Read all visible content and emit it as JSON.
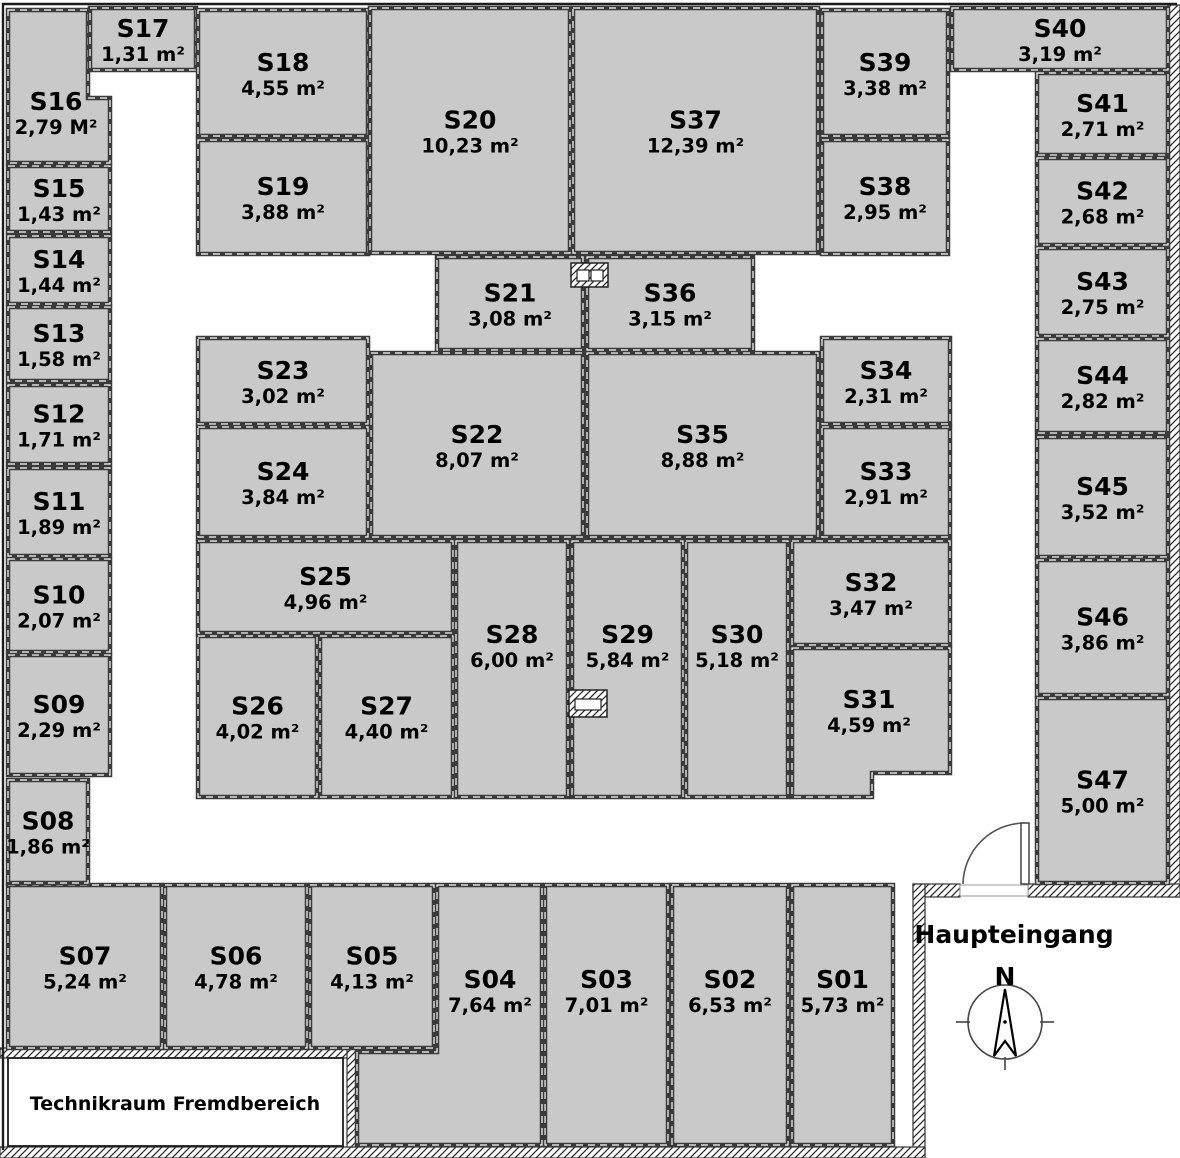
{
  "labels": {
    "haupteingang": "Haupteingang",
    "technikraum": "Technikraum Fremdbereich",
    "compass_n": "N"
  },
  "colors": {
    "room_fill": "#c9c9c9",
    "wall_stroke": "#3a3a3a",
    "text": "#000000"
  },
  "rooms": [
    {
      "id": "S01",
      "area": "5,73 m²",
      "x": 792,
      "y": 885,
      "w": 101,
      "h": 260,
      "ly": 990
    },
    {
      "id": "S02",
      "area": "6,53 m²",
      "x": 672,
      "y": 885,
      "w": 116,
      "h": 260,
      "ly": 990
    },
    {
      "id": "S03",
      "area": "7,01 m²",
      "x": 545,
      "y": 885,
      "w": 123,
      "h": 260,
      "ly": 990
    },
    {
      "id": "S04",
      "area": "7,64 m²",
      "pts": "437,885 542,885 542,1145 357,1145 357,1052 437,1052",
      "lx": 490,
      "ly": 990
    },
    {
      "id": "S05",
      "area": "4,13 m²",
      "x": 310,
      "y": 885,
      "w": 124,
      "h": 163
    },
    {
      "id": "S06",
      "area": "4,78 m²",
      "x": 165,
      "y": 885,
      "w": 142,
      "h": 163
    },
    {
      "id": "S07",
      "area": "5,24 m²",
      "x": 8,
      "y": 885,
      "w": 154,
      "h": 163
    },
    {
      "id": "S08",
      "area": "1,86 m²",
      "x": 8,
      "y": 780,
      "w": 80,
      "h": 103
    },
    {
      "id": "S09",
      "area": "2,29 m²",
      "x": 8,
      "y": 655,
      "w": 102,
      "h": 120
    },
    {
      "id": "S10",
      "area": "2,07 m²",
      "x": 8,
      "y": 559,
      "w": 102,
      "h": 93
    },
    {
      "id": "S11",
      "area": "1,89 m²",
      "x": 8,
      "y": 468,
      "w": 102,
      "h": 88
    },
    {
      "id": "S12",
      "area": "1,71 m²",
      "x": 8,
      "y": 385,
      "w": 102,
      "h": 79
    },
    {
      "id": "S13",
      "area": "1,58 m²",
      "x": 8,
      "y": 307,
      "w": 102,
      "h": 74
    },
    {
      "id": "S14",
      "area": "1,44 m²",
      "x": 8,
      "y": 236,
      "w": 102,
      "h": 68
    },
    {
      "id": "S15",
      "area": "1,43 m²",
      "x": 8,
      "y": 166,
      "w": 102,
      "h": 66
    },
    {
      "id": "S16",
      "area": "2,79 M²",
      "pts": "8,10 88,10 88,98 110,98 110,163 8,163",
      "lx": 56,
      "ly": 112
    },
    {
      "id": "S17",
      "area": "1,31 m²",
      "x": 90,
      "y": 8,
      "w": 106,
      "h": 62
    },
    {
      "id": "S18",
      "area": "4,55 m²",
      "x": 198,
      "y": 10,
      "w": 170,
      "h": 126
    },
    {
      "id": "S19",
      "area": "3,88 m²",
      "x": 198,
      "y": 140,
      "w": 170,
      "h": 114
    },
    {
      "id": "S20",
      "area": "10,23 m²",
      "x": 370,
      "y": 8,
      "w": 200,
      "h": 245
    },
    {
      "id": "S21",
      "area": "3,08 m²",
      "x": 437,
      "y": 257,
      "w": 146,
      "h": 93
    },
    {
      "id": "S22",
      "area": "8,07 m²",
      "x": 371,
      "y": 353,
      "w": 212,
      "h": 184
    },
    {
      "id": "S23",
      "area": "3,02 m²",
      "x": 198,
      "y": 338,
      "w": 170,
      "h": 86
    },
    {
      "id": "S24",
      "area": "3,84 m²",
      "x": 198,
      "y": 427,
      "w": 170,
      "h": 110
    },
    {
      "id": "S25",
      "area": "4,96 m²",
      "x": 198,
      "y": 541,
      "w": 255,
      "h": 92
    },
    {
      "id": "S26",
      "area": "4,02 m²",
      "x": 198,
      "y": 636,
      "w": 119,
      "h": 161
    },
    {
      "id": "S27",
      "area": "4,40 m²",
      "x": 320,
      "y": 636,
      "w": 133,
      "h": 161
    },
    {
      "id": "S28",
      "area": "6,00 m²",
      "x": 456,
      "y": 541,
      "w": 112,
      "h": 256,
      "ly": 645
    },
    {
      "id": "S29",
      "area": "5,84 m²",
      "x": 572,
      "y": 541,
      "w": 111,
      "h": 256,
      "ly": 645
    },
    {
      "id": "S30",
      "area": "5,18 m²",
      "x": 686,
      "y": 541,
      "w": 102,
      "h": 256,
      "ly": 645
    },
    {
      "id": "S31",
      "area": "4,59 m²",
      "pts": "792,648 950,648 950,773 872,773 872,797 792,797",
      "lx": 869,
      "ly": 710
    },
    {
      "id": "S32",
      "area": "3,47 m²",
      "x": 792,
      "y": 541,
      "w": 158,
      "h": 104
    },
    {
      "id": "S33",
      "area": "2,91 m²",
      "x": 822,
      "y": 427,
      "w": 128,
      "h": 110
    },
    {
      "id": "S34",
      "area": "2,31 m²",
      "x": 822,
      "y": 338,
      "w": 128,
      "h": 86
    },
    {
      "id": "S35",
      "area": "8,88 m²",
      "x": 587,
      "y": 353,
      "w": 231,
      "h": 184
    },
    {
      "id": "S36",
      "area": "3,15 m²",
      "x": 587,
      "y": 257,
      "w": 166,
      "h": 93
    },
    {
      "id": "S37",
      "area": "12,39 m²",
      "x": 573,
      "y": 8,
      "w": 245,
      "h": 245
    },
    {
      "id": "S38",
      "area": "2,95 m²",
      "x": 822,
      "y": 140,
      "w": 126,
      "h": 114
    },
    {
      "id": "S39",
      "area": "3,38 m²",
      "x": 822,
      "y": 10,
      "w": 126,
      "h": 126
    },
    {
      "id": "S40",
      "area": "3,19 m²",
      "x": 952,
      "y": 8,
      "w": 216,
      "h": 62
    },
    {
      "id": "S41",
      "area": "2,71 m²",
      "x": 1037,
      "y": 73,
      "w": 131,
      "h": 82
    },
    {
      "id": "S42",
      "area": "2,68 m²",
      "x": 1037,
      "y": 158,
      "w": 131,
      "h": 87
    },
    {
      "id": "S43",
      "area": "2,75 m²",
      "x": 1037,
      "y": 248,
      "w": 131,
      "h": 88
    },
    {
      "id": "S44",
      "area": "2,82 m²",
      "x": 1037,
      "y": 339,
      "w": 131,
      "h": 94
    },
    {
      "id": "S45",
      "area": "3,52 m²",
      "x": 1037,
      "y": 437,
      "w": 131,
      "h": 120
    },
    {
      "id": "S46",
      "area": "3,86 m²",
      "x": 1037,
      "y": 560,
      "w": 131,
      "h": 135
    },
    {
      "id": "S47",
      "area": "5,00 m²",
      "x": 1037,
      "y": 698,
      "w": 131,
      "h": 185
    }
  ]
}
